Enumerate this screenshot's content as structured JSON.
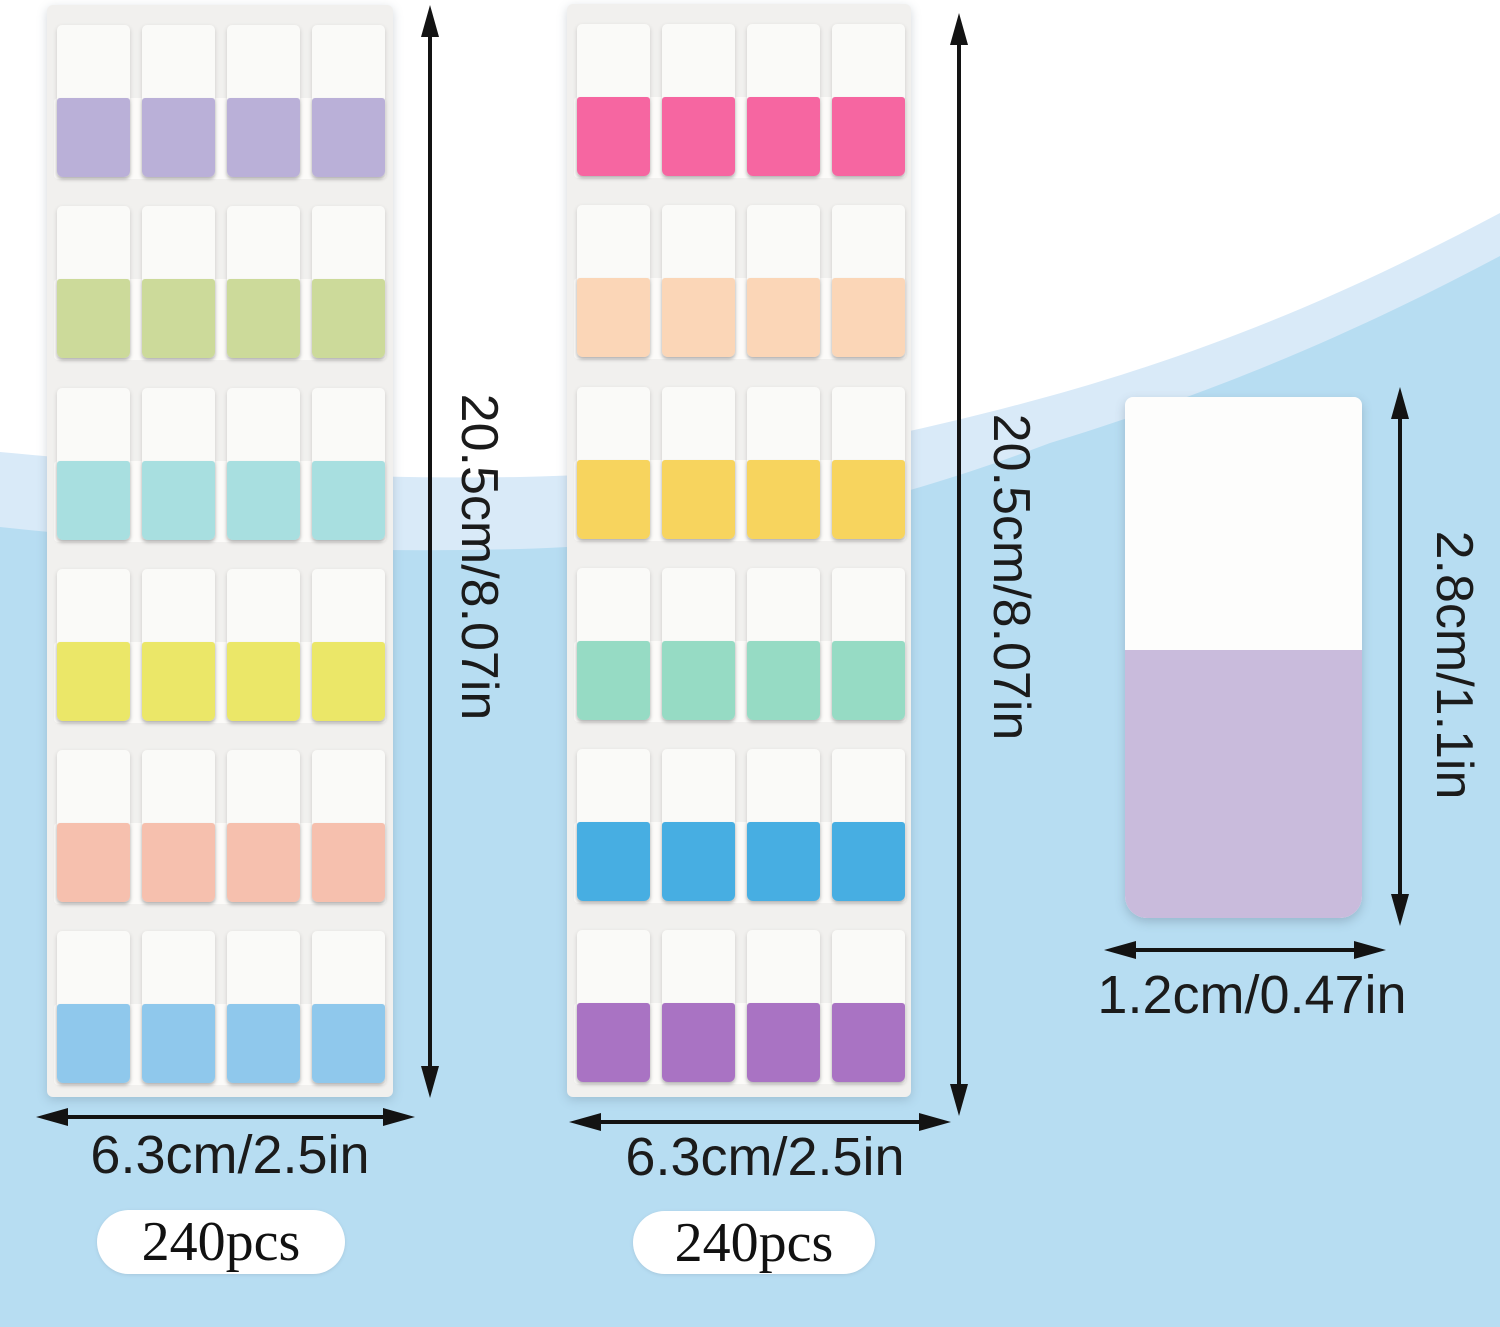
{
  "background": {
    "top_color": "#ffffff",
    "wave_band_color": "#d9eaf8",
    "main_blue_color": "#b7ddf2"
  },
  "sheets": [
    {
      "name": "tab-sheet-1",
      "rows": 6,
      "columns": 4,
      "height_label": "20.5cm/8.07in",
      "width_label": "6.3cm/2.5in",
      "count_badge": "240pcs",
      "row_colors": [
        "#bab0d8",
        "#ccda9a",
        "#a8dfe0",
        "#ebe768",
        "#f6c0ae",
        "#8fc8ec"
      ]
    },
    {
      "name": "tab-sheet-2",
      "rows": 6,
      "columns": 4,
      "height_label": "20.5cm/8.07in",
      "width_label": "6.3cm/2.5in",
      "count_badge": "240pcs",
      "row_colors": [
        "#f666a1",
        "#fbd6b7",
        "#f7d45e",
        "#96dbc4",
        "#47aee2",
        "#a973c3"
      ]
    }
  ],
  "single_tab": {
    "height_label": "2.8cm/1.1in",
    "width_label": "1.2cm/0.47in",
    "color": "#c9bbdc"
  }
}
